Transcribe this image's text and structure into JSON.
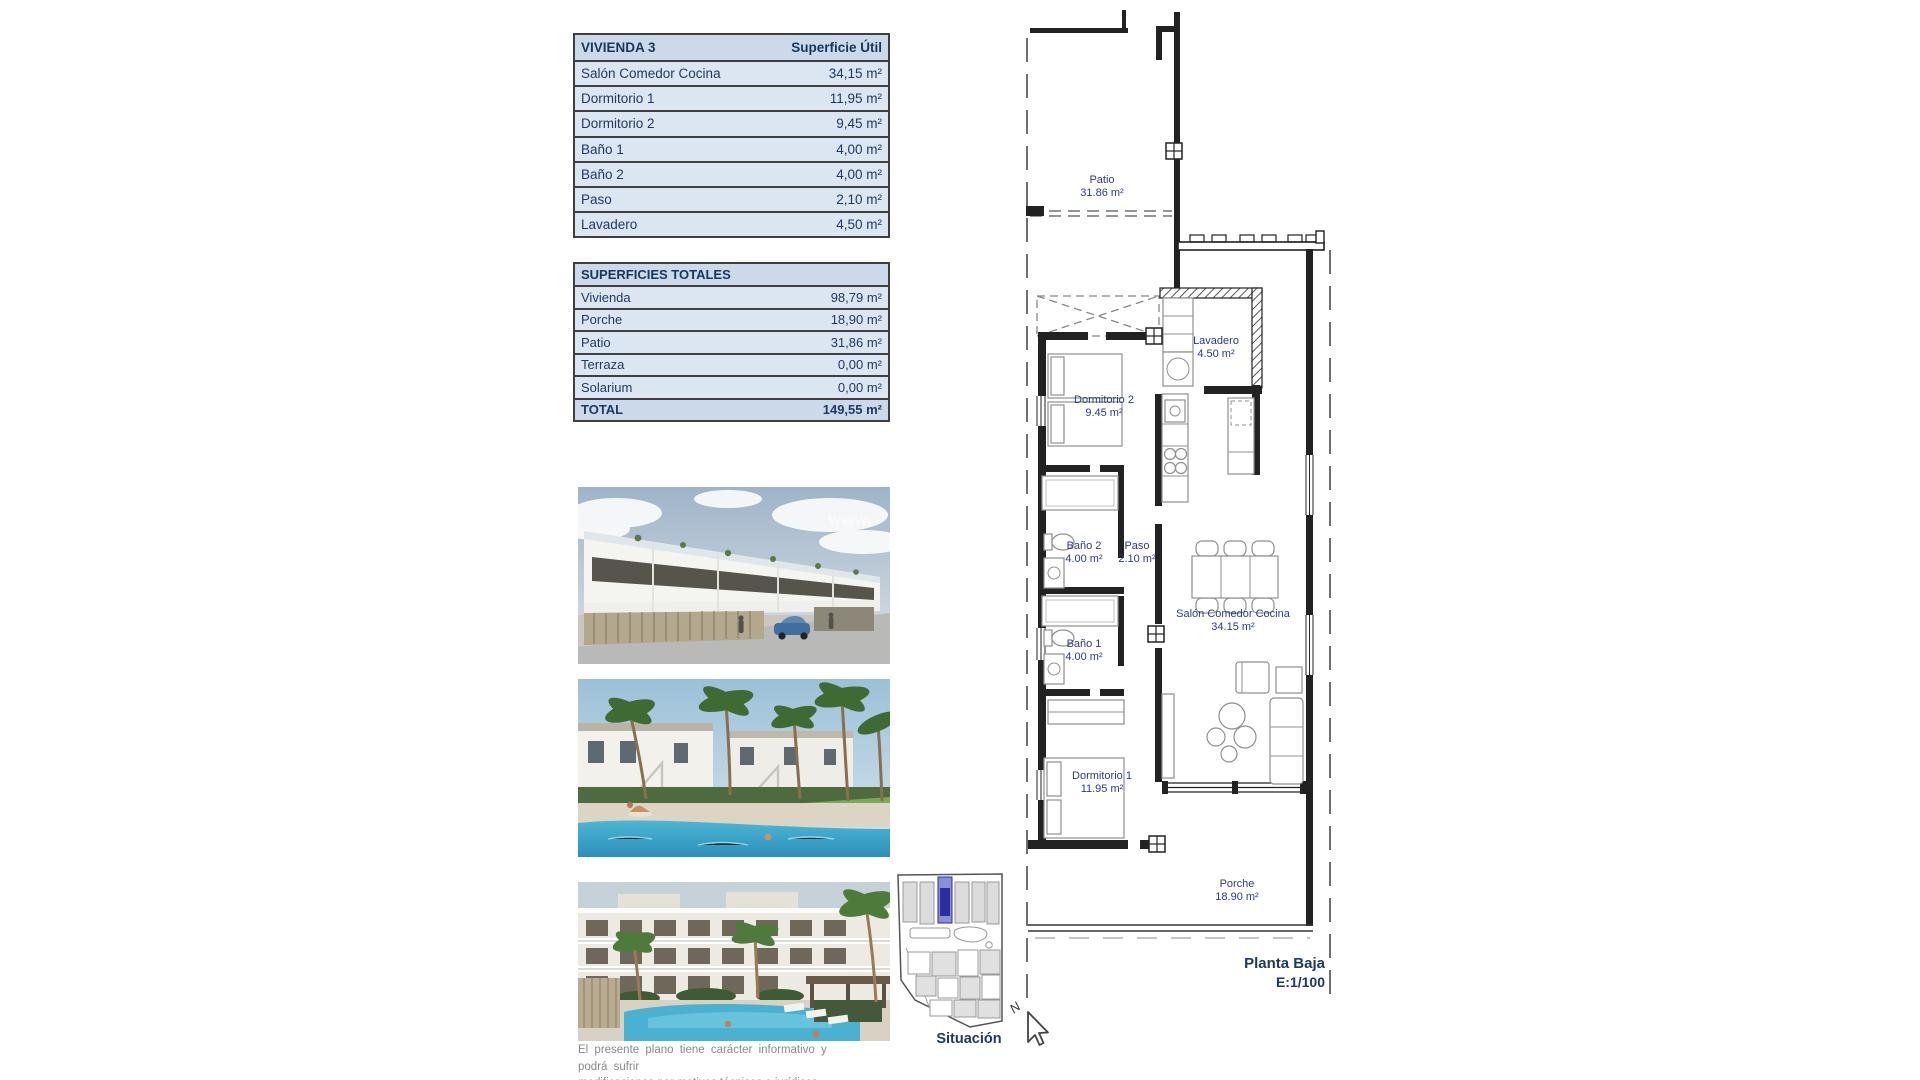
{
  "page": {
    "background": "#ffffff"
  },
  "vivienda_table": {
    "title": "VIVIENDA 3",
    "header_value": "Superficie Útil",
    "rows": [
      {
        "label": "Salón Comedor Cocina",
        "value": "34,15 m²"
      },
      {
        "label": "Dormitorio 1",
        "value": "11,95 m²"
      },
      {
        "label": "Dormitorio 2",
        "value": "9,45 m²"
      },
      {
        "label": "Baño 1",
        "value": "4,00 m²"
      },
      {
        "label": "Baño 2",
        "value": "4,00 m²"
      },
      {
        "label": "Paso",
        "value": "2,10 m²"
      },
      {
        "label": "Lavadero",
        "value": "4,50 m²"
      }
    ]
  },
  "totales_table": {
    "title": "SUPERFICIES TOTALES",
    "rows": [
      {
        "label": "Vivienda",
        "value": "98,79 m²"
      },
      {
        "label": "Porche",
        "value": "18,90 m²"
      },
      {
        "label": "Patio",
        "value": "31,86 m²"
      },
      {
        "label": "Terraza",
        "value": "0,00 m²"
      },
      {
        "label": "Solarium",
        "value": "0,00 m²"
      }
    ],
    "total_row": {
      "label": "TOTAL",
      "value": "149,55 m²"
    }
  },
  "floor_plan": {
    "rooms": [
      {
        "name": "Patio",
        "area": "31.86 m²"
      },
      {
        "name": "Lavadero",
        "area": "4.50 m²"
      },
      {
        "name": "Dormitorio 2",
        "area": "9.45 m²"
      },
      {
        "name": "Baño 2",
        "area": "4.00 m²"
      },
      {
        "name": "Paso",
        "area": "2.10 m²"
      },
      {
        "name": "Baño 1",
        "area": "4.00 m²"
      },
      {
        "name": "Salón Comedor Cocina",
        "area": "34.15 m²"
      },
      {
        "name": "Dormitorio 1",
        "area": "11.95 m²"
      },
      {
        "name": "Porche",
        "area": "18.90 m²"
      }
    ],
    "title": "Planta Baja",
    "scale": "E:1/100",
    "north_label": "N"
  },
  "situation_map": {
    "label": "Situación"
  },
  "photos": {
    "watermark": "www."
  },
  "disclaimer": {
    "line1": "El presente plano tiene carácter informativo y podrá sufrir",
    "line2": "modificaciones por motivos técnicos o jurídicos."
  },
  "colors": {
    "table_header_bg": "#ccd9ea",
    "table_row_bg": "#dce6f2",
    "table_border": "#3f3f3f",
    "navy_text": "#1f3864",
    "plan_label": "#2b3a8c",
    "highlight_unit_blue": "#2b2f9e",
    "pool_blue": "#45b0d2"
  }
}
